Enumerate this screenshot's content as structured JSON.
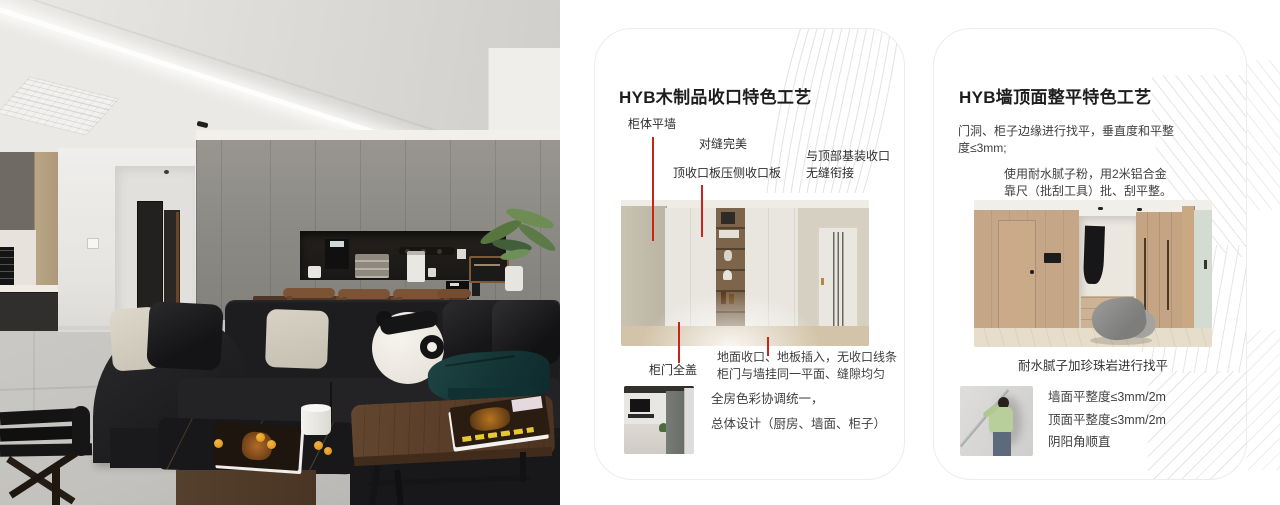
{
  "photo": {
    "alt": "现代客厅实景照片（深色沙发、熊猫抱枕、灰色定制柜）"
  },
  "colors": {
    "accent_red": "#c9241b"
  },
  "card1": {
    "title": "HYB木制品收口特色工艺",
    "callout_cabinet_flush_wall": "柜体平墙",
    "callout_seam_perfect": "对缝完美",
    "callout_top_closing_board": "顶收口板压侧收口板",
    "callout_ceiling_joint_line1": "与顶部基装收口",
    "callout_ceiling_joint_line2": "无缝衔接",
    "callout_door_full_cover": "柜门全盖",
    "note_line1": "地面收口、地板插入，无收口线条",
    "note_line2": "柜门与墙挂同一平面、缝隙均匀",
    "summary_line1": "全房色彩协调统一，",
    "summary_line2": "总体设计（厨房、墙面、柜子）"
  },
  "card2": {
    "title": "HYB墙顶面整平特色工艺",
    "para1_line1": "门洞、柜子边缘进行找平，垂直度和平整",
    "para1_line2": "度≤3mm;",
    "para2_line1": "使用耐水腻子粉，用2米铝合金",
    "para2_line2": "靠尺（批刮工具）批、刮平整。",
    "caption": "耐水腻子加珍珠岩进行找平",
    "spec1": "墙面平整度≤3mm/2m",
    "spec2": "顶面平整度≤3mm/2m",
    "spec3": "阴阳角顺直"
  }
}
